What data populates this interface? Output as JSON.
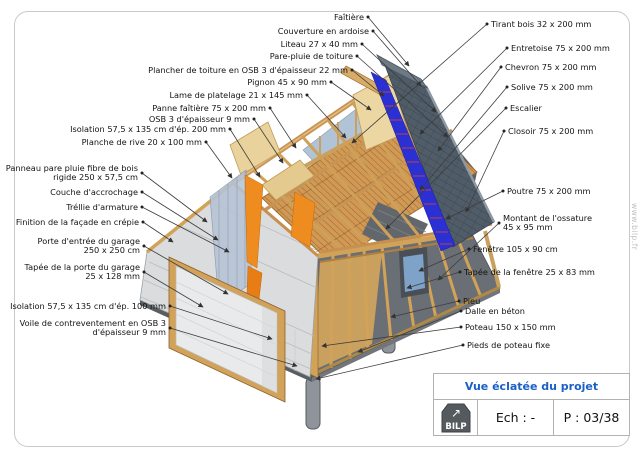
{
  "page": {
    "watermark": "www.bilp.fr",
    "border_color": "#c9c9c9",
    "background": "#ffffff"
  },
  "title_block": {
    "title": "Vue éclatée du projet",
    "title_color": "#1a5fc8",
    "logo_text": "BILP",
    "scale_label": "Ech : -",
    "page_label": "P : 03/38"
  },
  "colors": {
    "wood_light": "#d2a258",
    "wood_pale": "#ecd7a2",
    "wood_edge": "#8a5f2e",
    "orange_panel": "#ef8c1f",
    "slate_gray": "#505c68",
    "membrane_blue": "#2b30d4",
    "liteau_red": "#cc4433",
    "facade_gray": "#dadcdd",
    "glass_blue": "#a9bdd3",
    "pier_gray": "#8f949b",
    "leader_line": "#3d3d3d"
  },
  "labels": {
    "top_left": [
      {
        "name": "faitiere",
        "text": "Faîtière",
        "bx": 368,
        "by": 17,
        "tx": 409,
        "ty": 66
      },
      {
        "name": "couverture-ardoise",
        "text": "Couverture en ardoise",
        "bx": 373,
        "by": 31,
        "tx": 421,
        "ty": 86
      },
      {
        "name": "liteau",
        "text": "Liteau 27 x 40 mm",
        "bx": 362,
        "by": 44,
        "tx": 436,
        "ty": 112
      },
      {
        "name": "pare-pluie-toiture",
        "text": "Pare-pluie de toiture",
        "bx": 357,
        "by": 56,
        "tx": 448,
        "ty": 137
      },
      {
        "name": "plancher-toiture-osb",
        "text": "Plancher de toiture en OSB 3 d'épaisseur 22 mm",
        "bx": 352,
        "by": 70,
        "tx": 384,
        "ty": 96
      },
      {
        "name": "pignon",
        "text": "Pignon 45 x 90 mm",
        "bx": 331,
        "by": 82,
        "tx": 371,
        "ty": 110
      },
      {
        "name": "lame-platelage",
        "text": "Lame de platelage 21 x 145 mm",
        "bx": 307,
        "by": 95,
        "tx": 346,
        "ty": 138
      },
      {
        "name": "panne-faitiere",
        "text": "Panne faîtière 75 x 200 mm",
        "bx": 270,
        "by": 108,
        "tx": 296,
        "ty": 148
      },
      {
        "name": "osb-9mm",
        "text": "OSB 3 d'épaisseur 9 mm",
        "bx": 254,
        "by": 119,
        "tx": 283,
        "ty": 163
      },
      {
        "name": "isolation-200",
        "text": "Isolation 57,5 x 135 cm d'ép. 200 mm",
        "bx": 230,
        "by": 129,
        "tx": 260,
        "ty": 177
      },
      {
        "name": "planche-rive",
        "text": "Planche de rive 20 x 100 mm",
        "bx": 206,
        "by": 142,
        "tx": 232,
        "ty": 178
      }
    ],
    "right": [
      {
        "name": "tirant-bois",
        "text": "Tirant bois 32 x 200 mm",
        "bx": 487,
        "by": 24,
        "tx": 352,
        "ty": 143
      },
      {
        "name": "entretoise",
        "text": "Entretoise 75 x 200 mm",
        "bx": 507,
        "by": 48,
        "tx": 420,
        "ty": 134
      },
      {
        "name": "chevron",
        "text": "Chevron 75 x 200 mm",
        "bx": 501,
        "by": 67,
        "tx": 438,
        "ty": 151
      },
      {
        "name": "solive",
        "text": "Solive 75 x 200 mm",
        "bx": 507,
        "by": 87,
        "tx": 420,
        "ty": 190
      },
      {
        "name": "escalier",
        "text": "Escalier",
        "bx": 506,
        "by": 108,
        "tx": 386,
        "ty": 229
      },
      {
        "name": "closoir",
        "text": "Closoir 75 x 200 mm",
        "bx": 504,
        "by": 131,
        "tx": 466,
        "ty": 212
      },
      {
        "name": "poutre",
        "text": "Poutre 75 x 200 mm",
        "bx": 503,
        "by": 191,
        "tx": 446,
        "ty": 219
      },
      {
        "name": "montant-ossature",
        "text": "Montant de l'ossature\n45 x 95 mm",
        "bx": 499,
        "by": 223,
        "tx": 438,
        "ty": 280
      },
      {
        "name": "fenetre",
        "text": "Fenêtre 105 x 90 cm",
        "bx": 469,
        "by": 249,
        "tx": 419,
        "ty": 271
      },
      {
        "name": "tapee-fenetre",
        "text": "Tapée de la fenêtre 25 x 83 mm",
        "bx": 460,
        "by": 272,
        "tx": 407,
        "ty": 288
      },
      {
        "name": "pieu",
        "text": "Pieu",
        "bx": 459,
        "by": 301,
        "tx": 391,
        "ty": 317
      },
      {
        "name": "dalle-beton",
        "text": "Dalle en béton",
        "bx": 461,
        "by": 311,
        "tx": 358,
        "ty": 352
      },
      {
        "name": "poteau",
        "text": "Poteau 150 x 150 mm",
        "bx": 461,
        "by": 327,
        "tx": 322,
        "ty": 346
      },
      {
        "name": "pieds-poteau",
        "text": "Pieds de poteau fixe",
        "bx": 463,
        "by": 345,
        "tx": 316,
        "ty": 379
      }
    ],
    "left": [
      {
        "name": "panneau-pare-pluie",
        "text": "Panneau pare pluie fibre de bois\nrigide 250 x 57,5 cm",
        "bx": 142,
        "by": 173,
        "tx": 207,
        "ty": 222
      },
      {
        "name": "couche-accrochage",
        "text": "Couche d'accrochage",
        "bx": 142,
        "by": 192,
        "tx": 218,
        "ty": 240
      },
      {
        "name": "trellie-armature",
        "text": "Tréllie d'armature",
        "bx": 142,
        "by": 207,
        "tx": 229,
        "ty": 252
      },
      {
        "name": "finition-facade",
        "text": "Finition de la façade en  crépie",
        "bx": 143,
        "by": 222,
        "tx": 173,
        "ty": 242
      },
      {
        "name": "porte-garage",
        "text": "Porte d'entrée du garage\n250 x 250 cm",
        "bx": 144,
        "by": 246,
        "tx": 228,
        "ty": 294
      },
      {
        "name": "tapee-porte-garage",
        "text": "Tapée de la porte du garage\n25 x 128 mm",
        "bx": 144,
        "by": 272,
        "tx": 203,
        "ty": 307
      },
      {
        "name": "isolation-100",
        "text": "Isolation 57,5 x 135 cm d'ép. 100 mm",
        "bx": 170,
        "by": 306,
        "tx": 272,
        "ty": 339
      },
      {
        "name": "voile-osb",
        "text": "Voile de contreventement en OSB 3\nd'épaisseur 9 mm",
        "bx": 170,
        "by": 328,
        "tx": 297,
        "ty": 366
      }
    ]
  }
}
